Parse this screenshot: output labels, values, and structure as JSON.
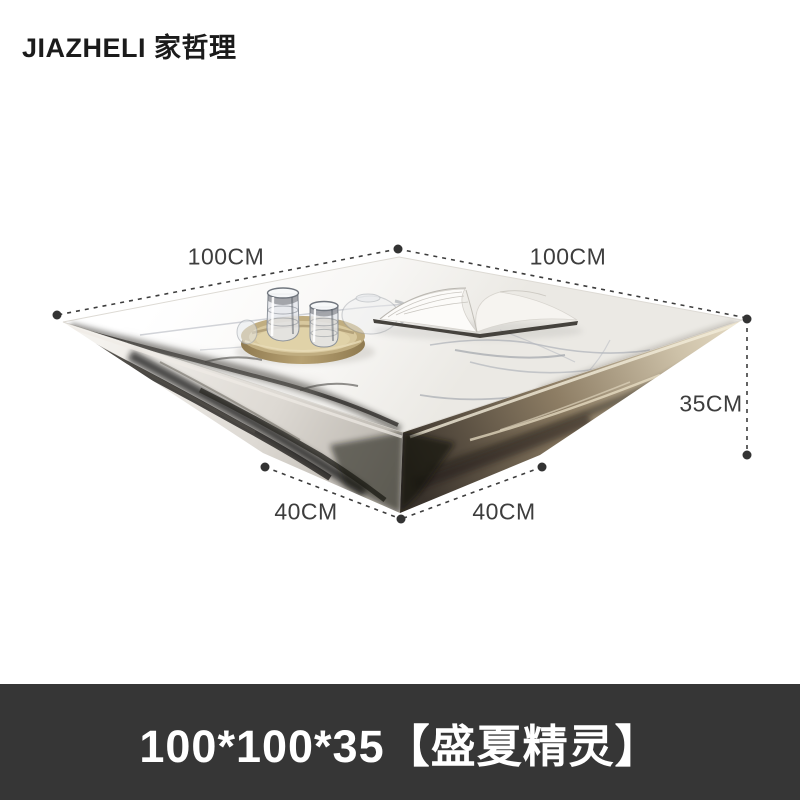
{
  "brand": {
    "logo_text": "JIAZHELI 家哲理"
  },
  "product": {
    "title_bar": "100*100*35【盛夏精灵】",
    "subject": "diamond-base marble coffee table with gold tray, crystal glasses and open magazine"
  },
  "dimensions": {
    "top_left": "100CM",
    "top_right": "100CM",
    "height": "35CM",
    "base_left": "40CM",
    "base_right": "40CM"
  },
  "colors": {
    "background": "#ffffff",
    "title_bar_bg": "#363636",
    "title_bar_text": "#ffffff",
    "annotation": "#3d3d3d",
    "logo_text": "#1b1b1b",
    "tray_gold": "#c0ad80",
    "bronze_face": "#9a8a6f",
    "marble_white": "#fbfbfa"
  }
}
